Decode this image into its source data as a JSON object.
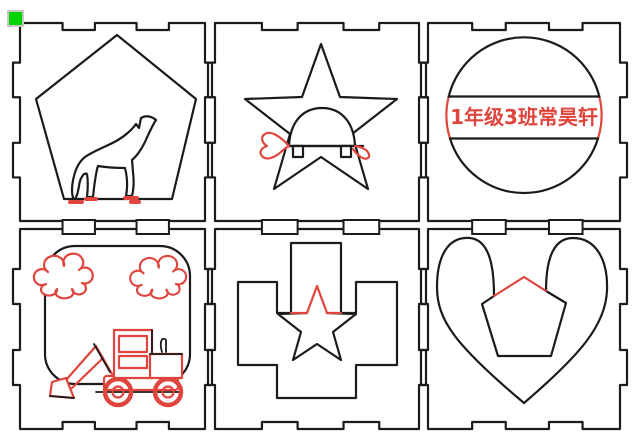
{
  "scene": {
    "type": "laser-cut-layout",
    "grid": "2 rows x 3 columns of finger-jointed square tiles",
    "marker": "origin-marker-green-square"
  },
  "colors": {
    "line": "#1b1b1b",
    "accent": "#e0453d",
    "marker": "#00d400",
    "background": "#ffffff"
  },
  "engraving": {
    "name_tag_text": "1年级3班常昊轩"
  },
  "tiles": [
    {
      "name": "tile-pentagon-wolf",
      "motifs": [
        "pentagon-outline",
        "howling-wolf-engraving",
        "red-paw-marks"
      ]
    },
    {
      "name": "tile-star-turtle",
      "motifs": [
        "five-point-star-outline",
        "turtle-engraving",
        "red-head-and-tail"
      ]
    },
    {
      "name": "tile-circle-name-tag",
      "motifs": [
        "circle-outline",
        "band-chords",
        "red-name-text"
      ]
    },
    {
      "name": "tile-clouds-loader",
      "motifs": [
        "rounded-square-outline",
        "red-clouds",
        "red-wheel-loader"
      ]
    },
    {
      "name": "tile-cross-star",
      "motifs": [
        "stepped-cross-outline",
        "slot-cuts",
        "star-with-red-tip"
      ]
    },
    {
      "name": "tile-heart-pentagon",
      "motifs": [
        "heart-outline",
        "pentagon-with-red-top"
      ]
    }
  ]
}
